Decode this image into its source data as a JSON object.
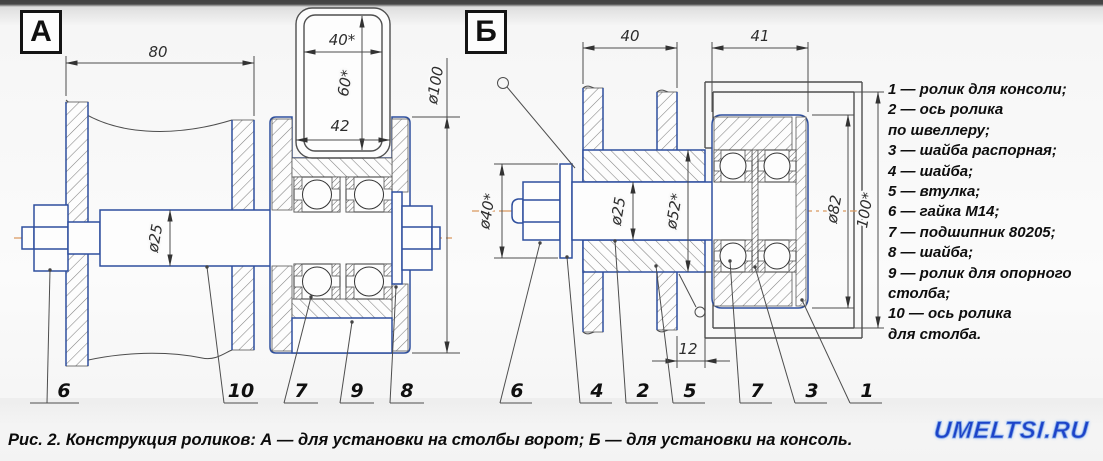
{
  "figure": {
    "caption": "Рис. 2. Конструкция роликов: А — для установки на столбы ворот; Б — для установки на консоль.",
    "watermark": "UMELTSI.RU",
    "colors": {
      "part_outline_blue": "#2e4f9e",
      "reference_gray": "#4f4f4f",
      "centerline_orange": "#d9995f",
      "watermark_blue": "#1c43c9"
    }
  },
  "drawing_a": {
    "label": "А",
    "dimensions": {
      "post_width": "80",
      "tube_width": "40*",
      "tube_height": "60*",
      "groove_width": "42",
      "axle_dia": "ø25",
      "roller_dia": "ø100"
    },
    "callouts": [
      "6",
      "10",
      "7",
      "9",
      "8"
    ]
  },
  "drawing_b": {
    "label": "Б",
    "dimensions": {
      "post_depth": "40",
      "roller_width": "41",
      "washer_dia": "ø40*",
      "axle_dia": "ø25",
      "bushing_dia": "ø52*",
      "roller_dia": "ø82",
      "channel_opening": "100*",
      "bushing_offset": "12"
    },
    "callouts": [
      "6",
      "4",
      "2",
      "5",
      "7",
      "3",
      "1"
    ]
  },
  "parts_list": {
    "lines": [
      "1 — ролик для консоли;",
      "2 — ось ролика",
      "по швеллеру;",
      "3 — шайба распорная;",
      "4 — шайба;",
      "5 — втулка;",
      "6 — гайка М14;",
      "7 — подшипник 80205;",
      "8 — шайба;",
      "9 — ролик для опорного",
      "столба;",
      "10 — ось ролика",
      "для столба."
    ]
  }
}
